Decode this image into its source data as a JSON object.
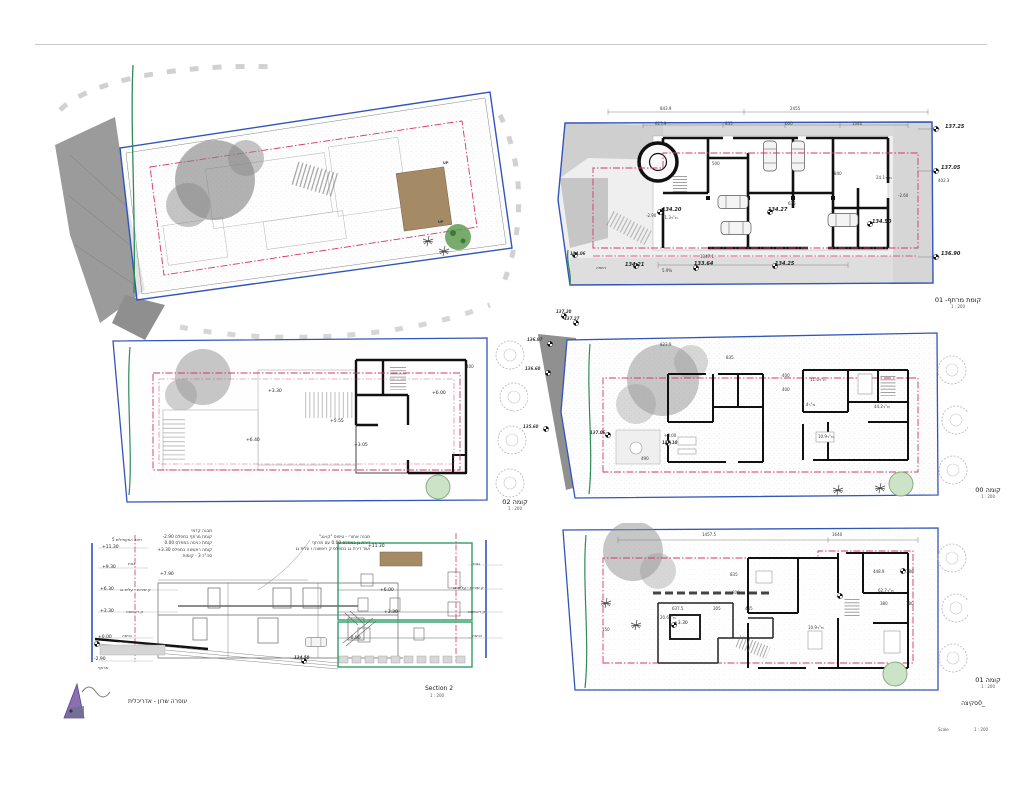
{
  "site": {
    "up": "UP"
  },
  "basement": {
    "title": "קומת מרתף- 01",
    "scale": "1 : 200",
    "dims_top": [
      "843.9",
      "2455"
    ],
    "dims_row2": [
      "823.9",
      "835",
      "600",
      "1040"
    ],
    "marks_right": [
      "137.25",
      "137.05",
      "402.3",
      "136.90"
    ],
    "mark_left": "134.06",
    "bottom": [
      "רמפה",
      "134.21",
      "5.9%",
      "133.64",
      "1347.1",
      "134.25"
    ],
    "interior": [
      "-2.90",
      "134.20",
      "מ\"ר71.3",
      "134.27",
      "134.50",
      "מ\"ר24.1",
      "-2.60",
      "500",
      "675",
      "840"
    ]
  },
  "roof": {
    "title": "קומה 02",
    "scale": "1 : 200",
    "marks": [
      "+3.30",
      "+5.55",
      "+6.40",
      "+6.00",
      "+3.05",
      "400"
    ]
  },
  "ground": {
    "title": "קומה 00",
    "scale": "1 : 200",
    "marks_left": [
      "137.20",
      "137.27",
      "136.97",
      "136.60",
      "135.60"
    ],
    "interior": [
      "823.9",
      "835",
      "400",
      "400",
      "מ\"ר11.6",
      "מ\"ר44.2",
      "מ\"ר7.4",
      "+0.00",
      "137.10",
      "137.06",
      "מ\"ר10.9",
      "490"
    ]
  },
  "first": {
    "title": "קומה 01",
    "scale": "1 : 200",
    "dims_top": [
      "1457.5",
      "1640"
    ],
    "interior": [
      "835",
      "800",
      "637.5",
      "305",
      "445",
      "מ\"ר20.6",
      "+3.30",
      "150",
      "מ\"ר62.7",
      "448.9",
      "180",
      "380",
      "180",
      "מ\"ר10.9"
    ],
    "sketch": "_0סקיצה",
    "scale_label": "Scale",
    "scale_value": "1 : 200"
  },
  "section": {
    "title": "Section 2",
    "scale": "1 : 200",
    "marks_left": [
      "+11.30",
      "+9.30",
      "+6.30",
      "+3.30",
      "+0.00",
      "-2.90"
    ],
    "labels_left": [
      "רחוב המעפילים 5",
      "גגות",
      "ק שירות - עלית גג",
      "ק ראשונה",
      "כניסה",
      "מרתף"
    ],
    "labels_right": [
      "גגות",
      "ק שירות - עלית גג",
      "ק ראשונה",
      "כניסה"
    ],
    "note_front": [
      "מבנה קדמי",
      "קומת מרתף במפלס 2.90-",
      "קומת כניסה במפלס 0.00",
      "קומה ראשונה במפלס 3.30+",
      "סה\"כ 3 - קומות"
    ],
    "note_rear": [
      "מבנה אחורי - טיפוס \"קו-גג\"",
      "דירת גן במפלס 0.00 עם מרתף",
      "ועוד דירת גג במפלס ק ראשונה ו עלית גג"
    ],
    "marks_inner": [
      "+7.90",
      "+11.30",
      "+6.00",
      "+3.30",
      "-0.00",
      "134.50"
    ]
  },
  "footer": {
    "architect": "עופרה שרון - אדריכלית"
  }
}
